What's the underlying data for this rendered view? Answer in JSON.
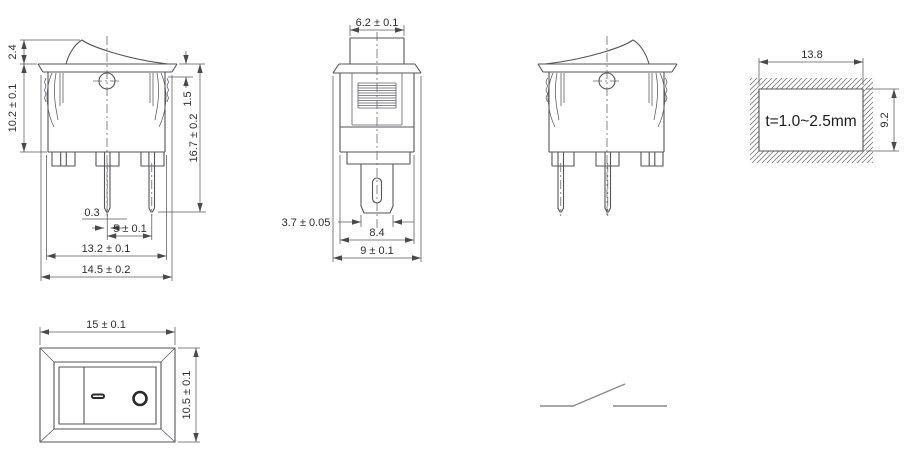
{
  "drawing": {
    "front_view": {
      "rocker_height": "2.4",
      "housing_height": "10.2 ± 0.1",
      "flange_to_snap": "1.5",
      "total_height": "16.7 ± 0.2",
      "terminal_thickness": "0.3",
      "terminal_pitch": "5 ± 0.1",
      "housing_width": "13.2 ± 0.1",
      "flange_width": "14.5 ± 0.2"
    },
    "side_view": {
      "actuator_width": "6.2 ± 0.1",
      "terminal_width": "3.7 ± 0.05",
      "housing_depth": "8.4",
      "flange_depth": "9 ± 0.1"
    },
    "panel_cutout": {
      "cutout_width": "13.8",
      "cutout_height": "9.2",
      "panel_thickness": "t=1.0~2.5mm"
    },
    "top_view": {
      "face_width": "15 ± 0.1",
      "face_height": "10.5 ± 0.1",
      "on_mark": "—",
      "off_mark": "O"
    }
  }
}
